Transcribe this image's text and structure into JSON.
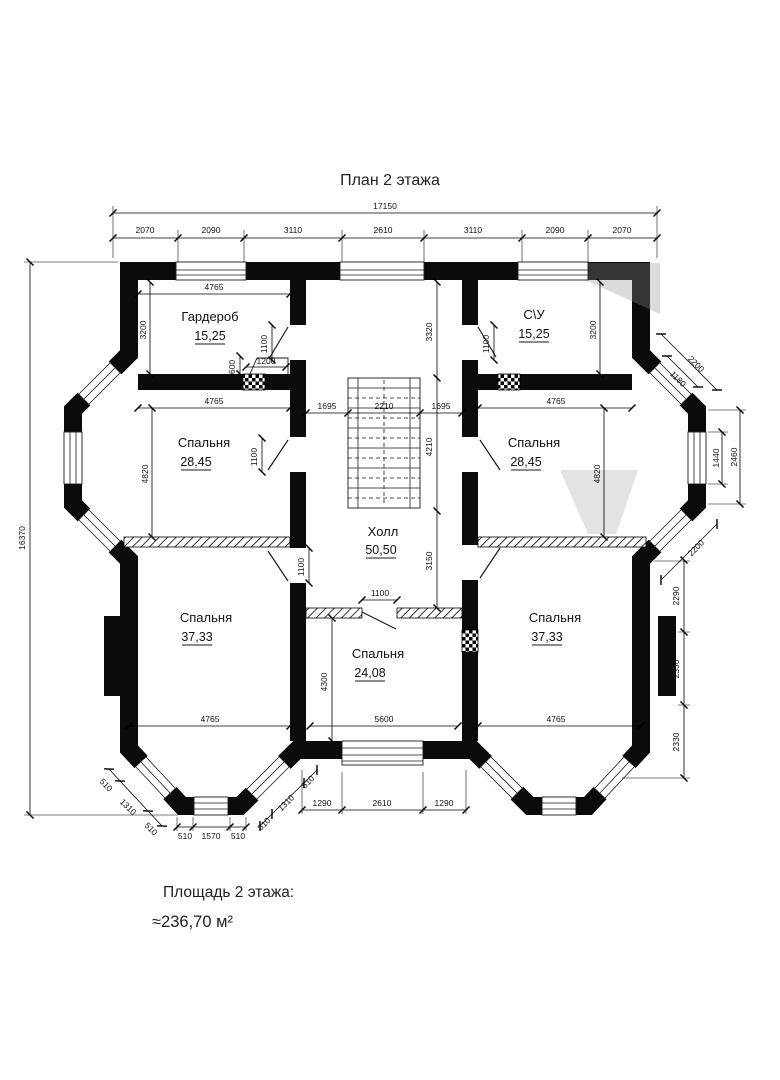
{
  "title": "План 2 этажа",
  "footer": {
    "label": "Площадь 2 этажа:",
    "value": "≈236,70 м²"
  },
  "rooms": [
    {
      "name": "Гардероб",
      "area": "15,25"
    },
    {
      "name": "С\\У",
      "area": "15,25"
    },
    {
      "name": "Спальня",
      "area": "28,45"
    },
    {
      "name": "Спальня",
      "area": "28,45"
    },
    {
      "name": "Спальня",
      "area": "37,33"
    },
    {
      "name": "Спальня",
      "area": "24,08"
    },
    {
      "name": "Спальня",
      "area": "37,33"
    },
    {
      "name": "Холл",
      "area": "50,50"
    }
  ],
  "dims": {
    "top_total": "17150",
    "top_chain": [
      "2070",
      "2090",
      "3110",
      "2610",
      "3110",
      "2090",
      "2070"
    ],
    "left_total": "16370",
    "right_bay": {
      "diag": "2200",
      "diag_window": "1180",
      "window_h": "1440",
      "face_h": "2460",
      "diag_lower": "2200"
    },
    "right_chain": [
      "2290",
      "2330",
      "2330"
    ],
    "bottom_chain": [
      "1290",
      "2610",
      "1290"
    ],
    "corner_bay": {
      "diag_left": [
        "510",
        "1310",
        "510"
      ],
      "diag_right": [
        "510",
        "1310",
        "510"
      ],
      "face": [
        "510",
        "1570",
        "510"
      ]
    },
    "interior": {
      "wardrobe_w": "4765",
      "wardrobe_h": "3200",
      "wardrobe_door": "1100",
      "niche_h": "600",
      "niche_w": "1200",
      "wc_door": "1100",
      "wc_h": "3200",
      "bedroom_ml_w": "4765",
      "bedroom_ml_h": "4820",
      "bedroom_ml_door": "1100",
      "bedroom_mr_w": "4765",
      "bedroom_mr_h": "4820",
      "hall_top": "3320",
      "hall_left": "1695",
      "stair_w": "2210",
      "hall_right": "1695",
      "stair_h": "4210",
      "hall_bottom": "3150",
      "bedroom_bl_door": "1100",
      "bedroom_bl_w": "4765",
      "bedroom_bm_door": "1100",
      "bedroom_bm_h": "4300",
      "bedroom_bm_w": "5600",
      "bedroom_br_w": "4765"
    }
  }
}
